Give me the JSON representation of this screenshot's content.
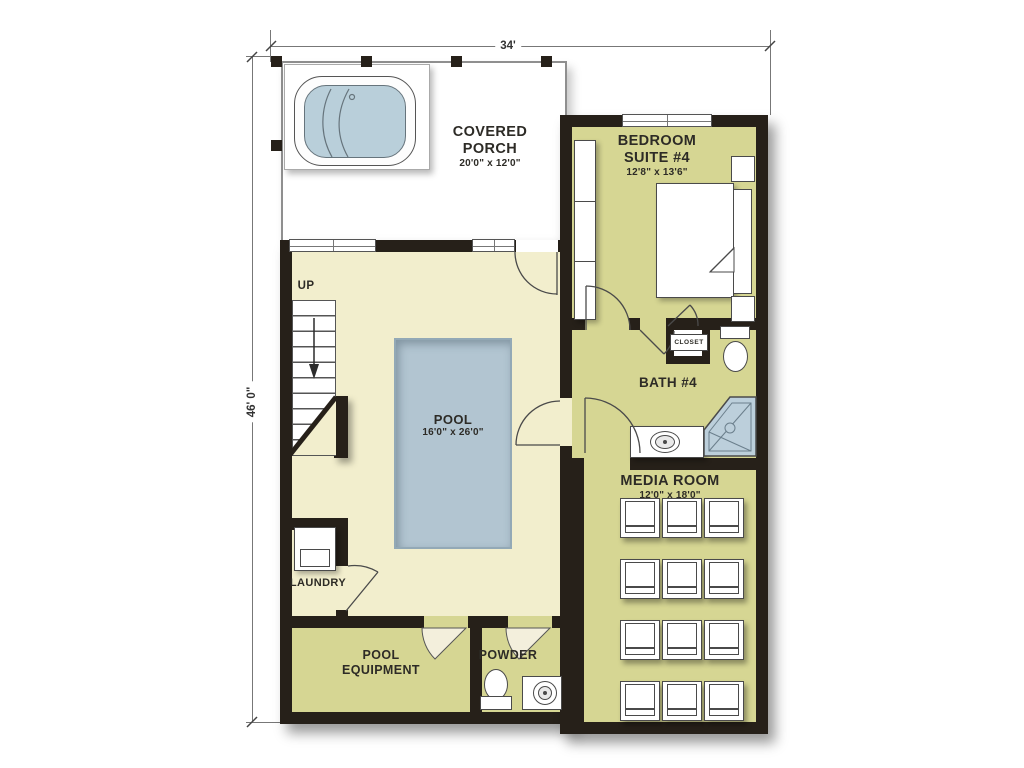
{
  "dims": {
    "top": "34'",
    "left": "46' 0\""
  },
  "rooms": {
    "covered_porch": {
      "line1": "COVERED",
      "line2": "PORCH",
      "size": "20'0\" x 12'0\""
    },
    "bedroom_suite_4": {
      "line1": "BEDROOM",
      "line2": "SUITE #4",
      "size": "12'8\" x 13'6\""
    },
    "pool": {
      "name": "POOL",
      "size": "16'0\" x 26'0\""
    },
    "stairs": {
      "label": "UP"
    },
    "laundry": {
      "name": "LAUNDRY"
    },
    "pool_equipment": {
      "line1": "POOL",
      "line2": "EQUIPMENT"
    },
    "powder": {
      "name": "POWDER"
    },
    "bath_4": {
      "name": "BATH #4"
    },
    "closet": {
      "name": "CLOSET"
    },
    "media_room": {
      "name": "MEDIA ROOM",
      "size": "12'0\" x 18'0\""
    }
  },
  "colors": {
    "wall": "#262019",
    "pool_room_floor": "#f2eecd",
    "suite_floor": "#d6d693",
    "pool_water": "#b2c5d1",
    "shower_pan": "#bccfdb",
    "fixture_outline": "#4a4a4a",
    "label_text": "#2d2b26"
  }
}
